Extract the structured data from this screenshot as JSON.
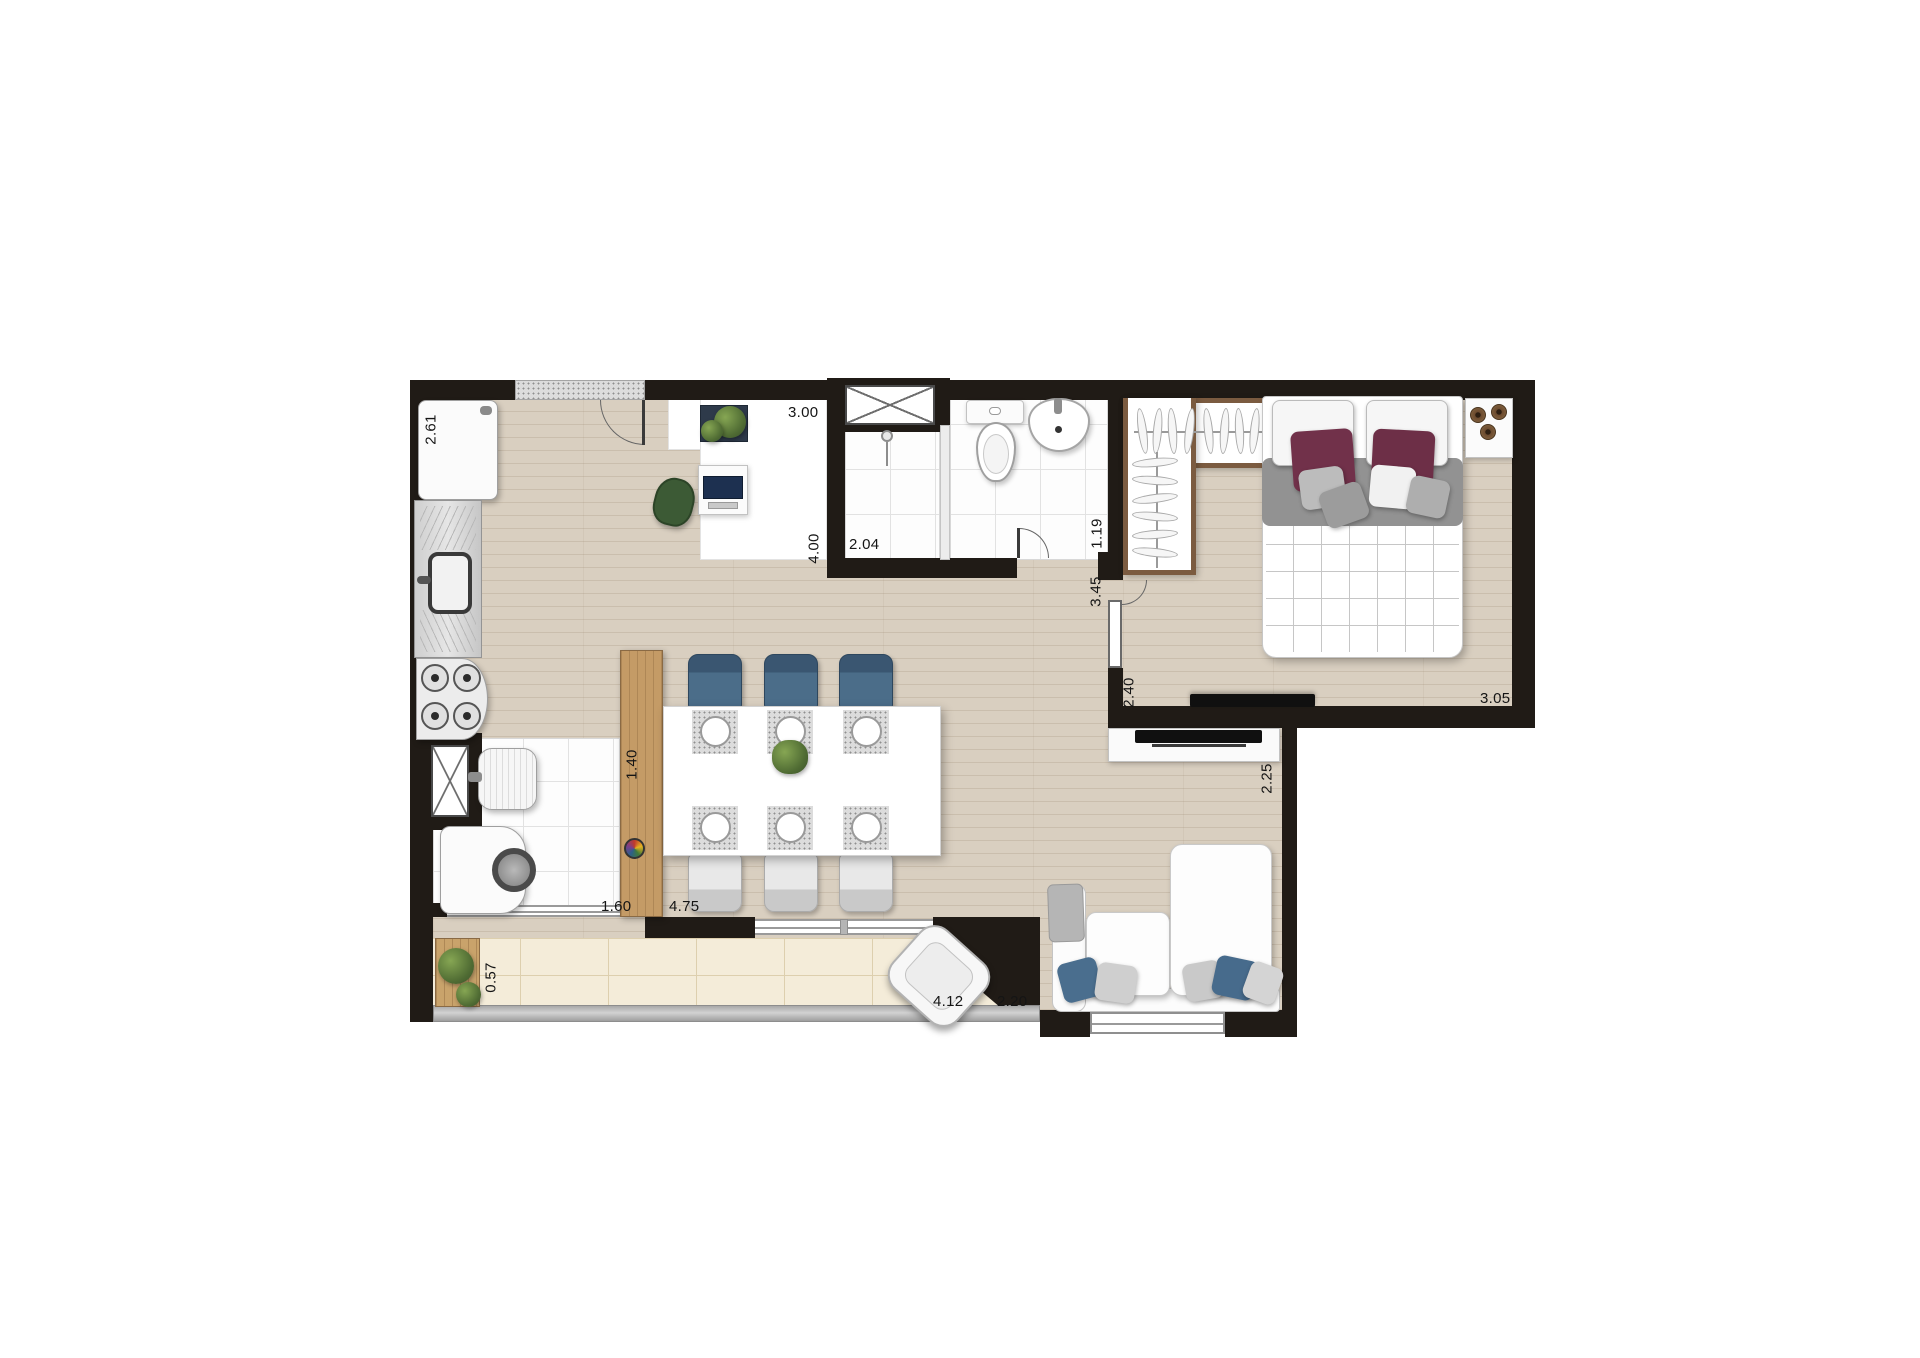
{
  "fp": {
    "dims": {
      "kitchen_width": "2.61",
      "entry_hall_width": "3.00",
      "entry_hall_length": "4.00",
      "shower_room": "2.04",
      "bathroom_length": "1.19",
      "living_length": "3.45",
      "bedroom_tv_wall": "2.40",
      "bedroom_width": "3.05",
      "tv_side_wall": "2.25",
      "counter_length": "1.40",
      "laundry_width": "1.60",
      "living_width": "4.75",
      "balcony_depth": "0.57",
      "balcony_length": "4.12",
      "sofa_window_wall": "2.20"
    },
    "colors": {
      "wall": "#201b16",
      "wood_floor": "#d9cfc0",
      "balcony_tile": "#f4ecd9",
      "closet_wood": "#7b5b40",
      "counter_wood": "#c49b66",
      "chair_blue": "#4b6d89",
      "pillow_maroon": "#6d2f47",
      "chair_green": "#3c5a35",
      "plant_green": "#4f6b33"
    }
  }
}
